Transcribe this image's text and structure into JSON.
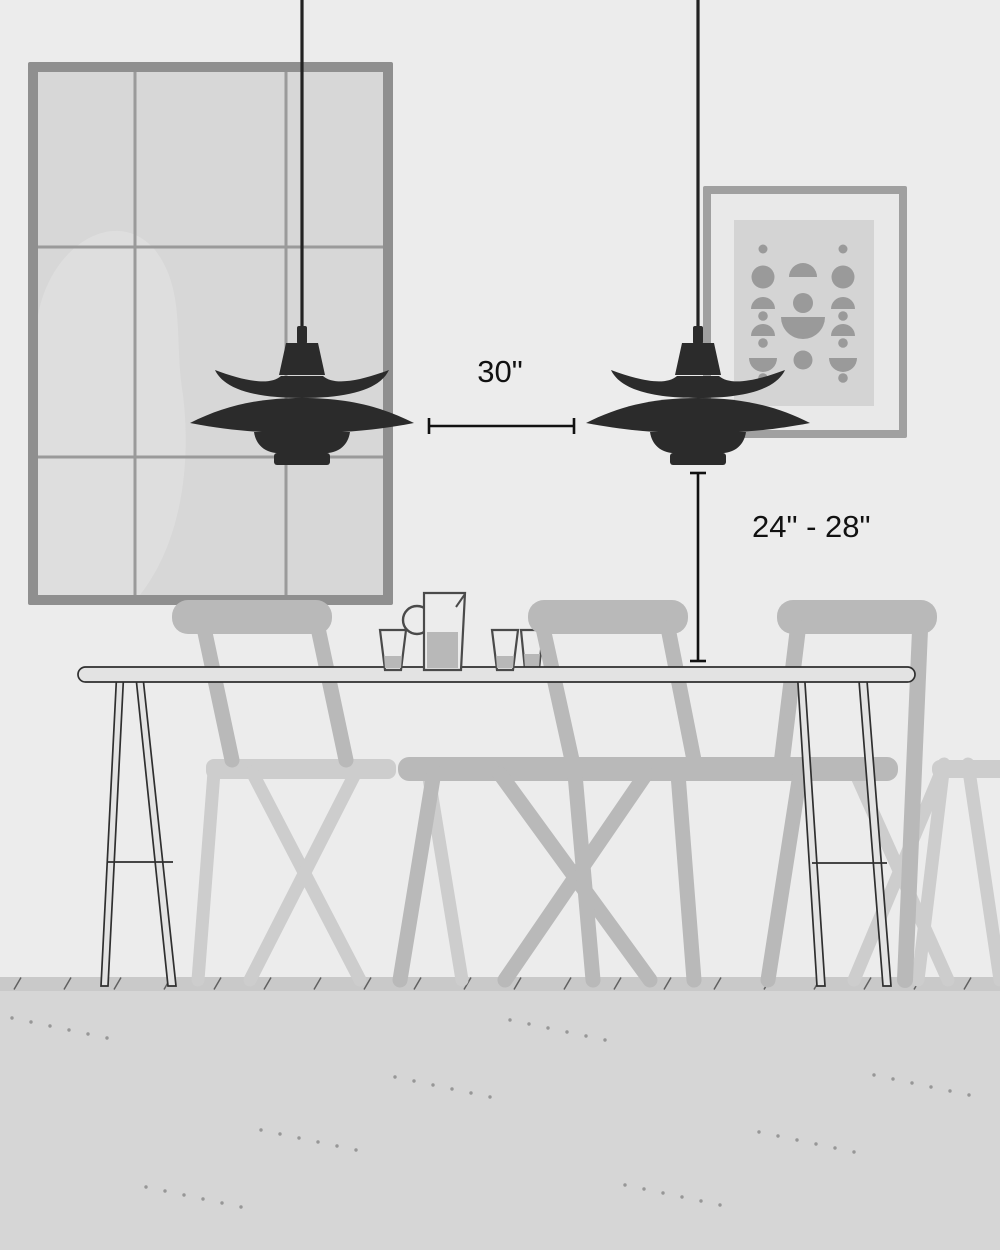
{
  "title": "Dining table pendant light spacing and height guide",
  "annotations": {
    "pendant_spacing_label": "30\"",
    "pendant_height_label": "24\" - 28\""
  },
  "objects": {
    "pendant_lamp_left": "PH5-style pendant lamp",
    "pendant_lamp_right": "PH5-style pendant lamp",
    "window": "3x3 pane window with sheer curtain",
    "artwork": "framed abstract mid-century print",
    "table": "dining table with splayed legs",
    "chairs": "three dining chairs",
    "tableware": "pitcher and three glasses"
  },
  "colors": {
    "wall": "#ececec",
    "floor": "#d6d6d6",
    "baseboard": "#c9c9c9",
    "lamp": "#2b2b2b",
    "frame-gray": "#8f8f8f",
    "pane": "#d7d7d7",
    "curtain": "#e0e0e0",
    "chair-dark": "#b9b9b9",
    "chair-light": "#cdcdcd",
    "table-fill": "#e3e3e3",
    "outline": "#2f2f2f",
    "annotation": "#111111",
    "art-frame": "#a0a0a0",
    "art-mat": "#e9e9e9",
    "art-bg": "#d4d4d4",
    "art-shape": "#9a9a9a",
    "glass-stroke": "#4a4a4a",
    "liquid": "#b8b8b8",
    "dot": "#979797",
    "tick": "#606060"
  }
}
